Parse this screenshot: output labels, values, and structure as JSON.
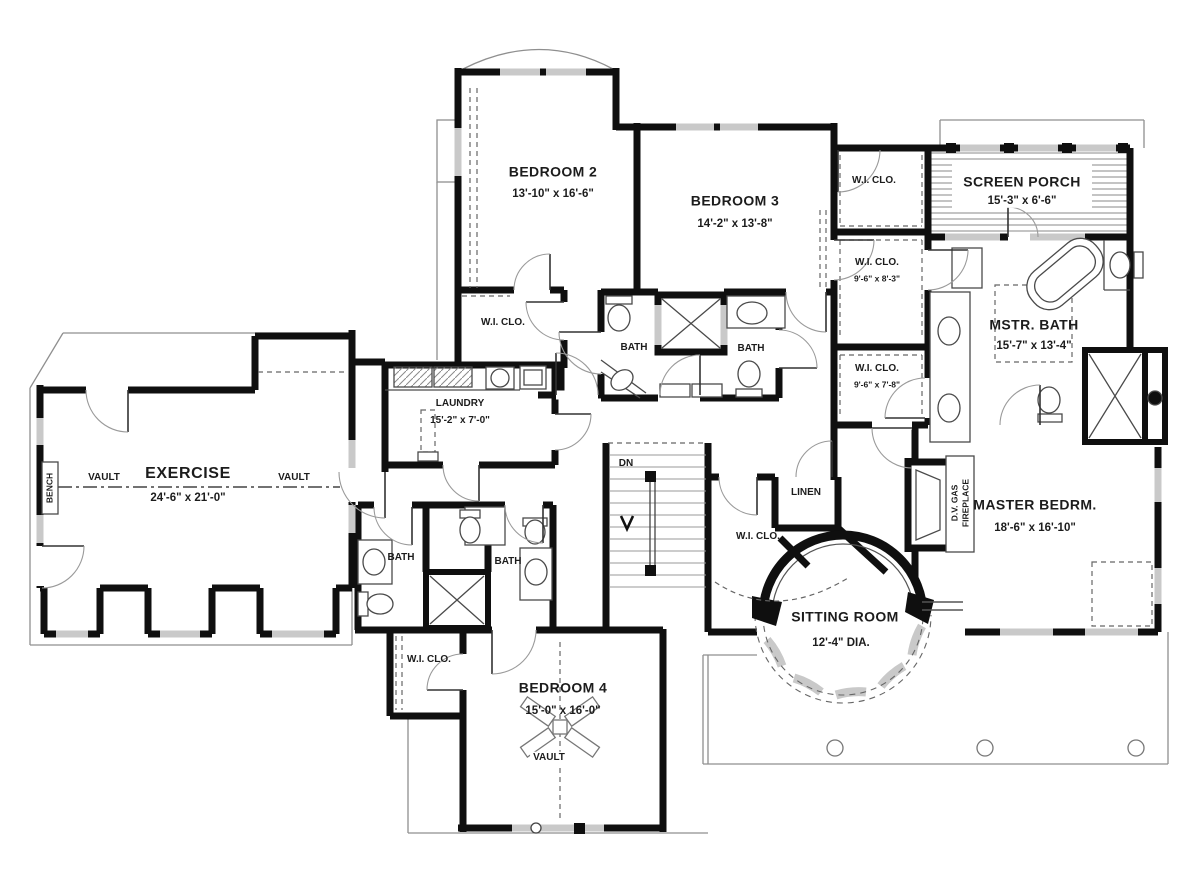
{
  "colors": {
    "wall": "#0f0f0f",
    "window": "#c9c9c9",
    "background": "#ffffff"
  },
  "rooms": {
    "bedroom2": {
      "name": "BEDROOM 2",
      "dims": "13'-10\" x 16'-6\""
    },
    "bedroom3": {
      "name": "BEDROOM 3",
      "dims": "14'-2\" x 13'-8\""
    },
    "screen_porch": {
      "name": "SCREEN PORCH",
      "dims": "15'-3\" x 6'-6\""
    },
    "master_bath": {
      "name": "MSTR. BATH",
      "dims": "15'-7\" x 13'-4\""
    },
    "master_bedroom": {
      "name": "MASTER BEDRM.",
      "dims": "18'-6\" x 16'-10\""
    },
    "sitting_room": {
      "name": "SITTING ROOM",
      "dims": "12'-4\" DIA."
    },
    "exercise": {
      "name": "EXERCISE",
      "dims": "24'-6\" x 21'-0\""
    },
    "laundry": {
      "name": "LAUNDRY",
      "dims": "15'-2\" x 7'-0\""
    },
    "bedroom4": {
      "name": "BEDROOM 4",
      "dims": "15'-0\" x 16'-0\""
    }
  },
  "closets": {
    "wic": "W.I. CLO.",
    "wic_83_dims": "9'-6\" x 8'-3\"",
    "wic_78_dims": "9'-6\" x 7'-8\"",
    "linen": "LINEN"
  },
  "labels": {
    "bath": "BATH",
    "vault": "VAULT",
    "bench": "BENCH",
    "dn": "DN",
    "fireplace_line1": "D.V. GAS",
    "fireplace_line2": "FIREPLACE"
  }
}
